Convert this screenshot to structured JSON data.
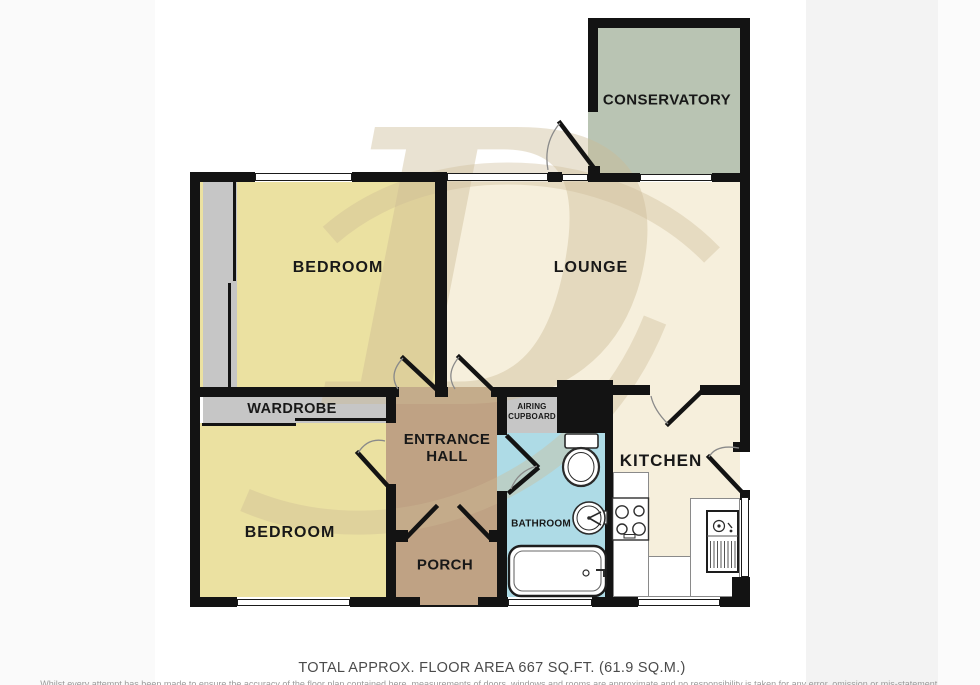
{
  "colors": {
    "wall": "#131313",
    "bedroom": "#ebe1a1",
    "lounge": "#f6efdc",
    "conservatory": "#b9c4b3",
    "hall": "#bfa284",
    "bathroom": "#aedbe6",
    "storage": "#c6c6c6",
    "watermark": "#cdbb95"
  },
  "watermark": {
    "glyph": "D"
  },
  "rooms": {
    "conservatory": {
      "label": "CONSERVATORY"
    },
    "lounge": {
      "label": "LOUNGE"
    },
    "bedroom1": {
      "label": "BEDROOM"
    },
    "bedroom2": {
      "label": "BEDROOM"
    },
    "kitchen": {
      "label": "KITCHEN"
    },
    "bathroom": {
      "label": "BATHROOM"
    },
    "entrance_hall": {
      "line1": "ENTRANCE",
      "line2": "HALL"
    },
    "porch": {
      "label": "PORCH"
    },
    "wardrobe": {
      "label": "WARDROBE"
    },
    "airing_cupboard": {
      "line1": "AIRING",
      "line2": "CUPBOARD"
    }
  },
  "footer": {
    "area_text": "TOTAL APPROX. FLOOR AREA 667 SQ.FT. (61.9 SQ.M.)",
    "disclaimer_text": "Whilst every attempt has been made to ensure the accuracy of the floor plan contained here, measurements of doors, windows and rooms are approximate and no responsibility is taken for any error, omission or mis-statement."
  }
}
